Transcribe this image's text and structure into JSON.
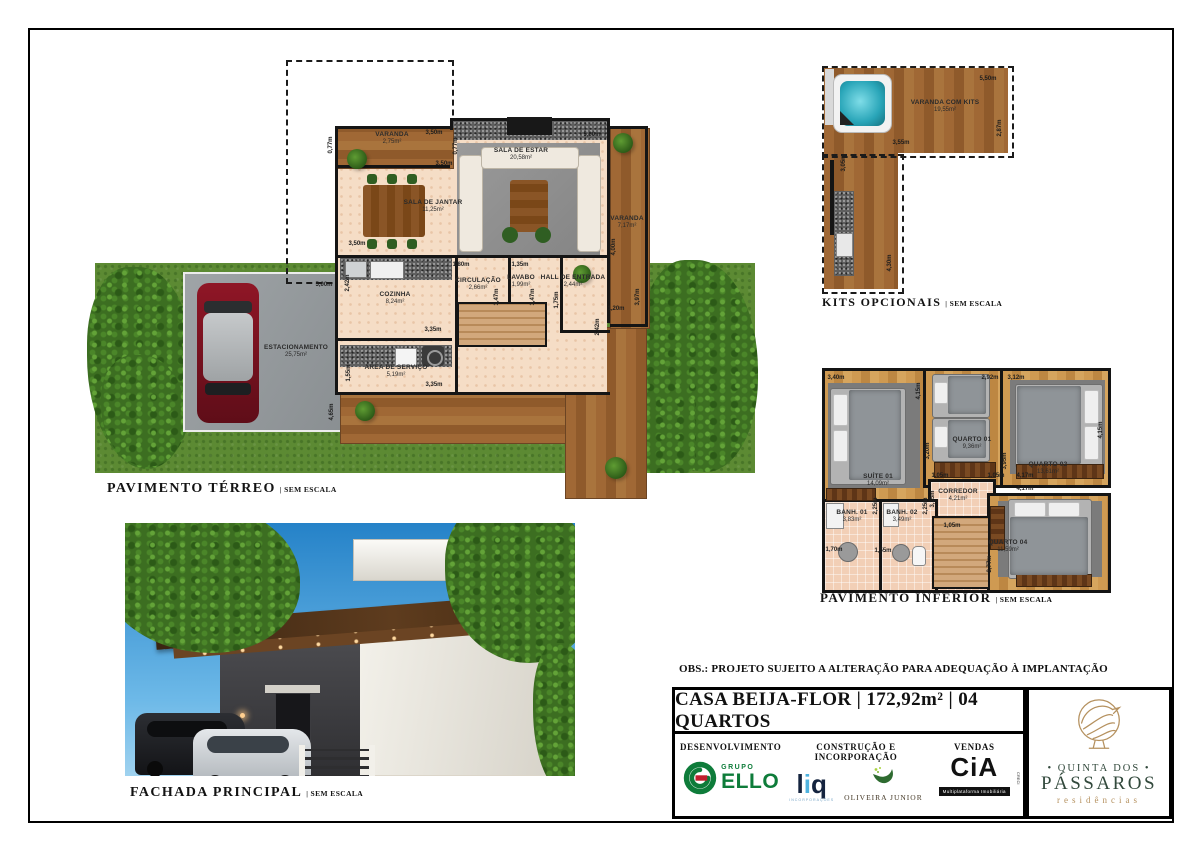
{
  "sheet": {
    "obs": "OBS.: PROJETO SUJEITO A ALTERAÇÃO PARA ADEQUAÇÃO À IMPLANTAÇÃO",
    "title": "CASA BEIJA-FLOR | 172,92m² | 04 QUARTOS",
    "scale_note": "| SEM ESCALA"
  },
  "plans": {
    "terreo": {
      "caption": "PAVIMENTO TÉRREO",
      "rooms": [
        {
          "name": "VARANDA",
          "area": "2,75m²"
        },
        {
          "name": "SALA DE ESTAR",
          "area": "20,58m²"
        },
        {
          "name": "SALA DE JANTAR",
          "area": "11,25m²"
        },
        {
          "name": "VARANDA",
          "area": "7,17m²"
        },
        {
          "name": "CIRCULAÇÃO",
          "area": "2,66m²"
        },
        {
          "name": "LAVABO",
          "area": "1,99m²"
        },
        {
          "name": "HALL DE ENTRADA",
          "area": "2,44m²"
        },
        {
          "name": "COZINHA",
          "area": "8,24m²"
        },
        {
          "name": "ÁREA DE SERVIÇO",
          "area": "5,19m²"
        },
        {
          "name": "ESTACIONAMENTO",
          "area": "25,75m²"
        }
      ],
      "dims": [
        "3,50m",
        "0,77m",
        "5,00m",
        "0,77m",
        "3,50m",
        "3,50m",
        "4,00m",
        "1,80m",
        "1,35m",
        "1,47m",
        "1,47m",
        "1,75m",
        "2,42m",
        "3,35m",
        "1,55m",
        "3,35m",
        "5,00m",
        "4,65m",
        "1,20m",
        "3,97m",
        "2,42m"
      ]
    },
    "kits": {
      "caption": "KITS OPCIONAIS",
      "room": {
        "name": "VARANDA COM KITS",
        "area": "19,55m²"
      },
      "dims": [
        "5,50m",
        "3,55m",
        "2,87m",
        "3,05m",
        "4,30m"
      ]
    },
    "inferior": {
      "caption": "PAVIMENTO INFERIOR",
      "rooms": [
        {
          "name": "SUÍTE 01",
          "area": "14,09m²"
        },
        {
          "name": "QUARTO 01",
          "area": "9,36m²"
        },
        {
          "name": "QUARTO 02",
          "area": "13,61m²"
        },
        {
          "name": "CORREDOR",
          "area": "4,21m²"
        },
        {
          "name": "BANH. 01",
          "area": "3,83m²"
        },
        {
          "name": "BANH. 02",
          "area": "3,49m²"
        },
        {
          "name": "QUARTO 04",
          "area": "11,59m²"
        }
      ],
      "dims": [
        "3,40m",
        "4,15m",
        "2,92m",
        "3,20m",
        "3,12m",
        "3,95m",
        "1,05m",
        "3,35m",
        "1,05m",
        "4,17m",
        "4,17m",
        "2,25m",
        "2,25m",
        "1,70m",
        "1,55m",
        "1,05m",
        "2,77m",
        "4,15m"
      ]
    },
    "fachada": {
      "caption": "FACHADA PRINCIPAL"
    }
  },
  "title_block": {
    "col1": "DESENVOLVIMENTO",
    "col2": "CONSTRUÇÃO E INCORPORAÇÃO",
    "col3": "VENDAS"
  },
  "logos": {
    "ello": {
      "group": "GRUPO",
      "name": "ELLO"
    },
    "liq": {
      "p1": "l",
      "p2": "i",
      "p3": "q",
      "sub": "INCORPORAÇÕES"
    },
    "oliveira": {
      "name": "OLIVEIRA JUNIOR"
    },
    "cia": {
      "name": "CiA",
      "sub": "Multiplataforma Imobiliária",
      "creci": "CRECI"
    }
  },
  "brand": {
    "line1": "• QUINTA DOS •",
    "line2": "PÁSSAROS",
    "line3": "residências"
  },
  "colors": {
    "wall": "#151515",
    "grass": "#5c8a33",
    "wood": "#9b6434",
    "floor": "#f5ddc6",
    "ello_green": "#0e7c3a",
    "ello_red": "#c01f2e",
    "liq_blue": "#4fb3e0",
    "oliveira_green": "#2e6b30",
    "brand_tan": "#b5915f",
    "brand_green": "#32493c",
    "sky": "#2f8fd2"
  }
}
